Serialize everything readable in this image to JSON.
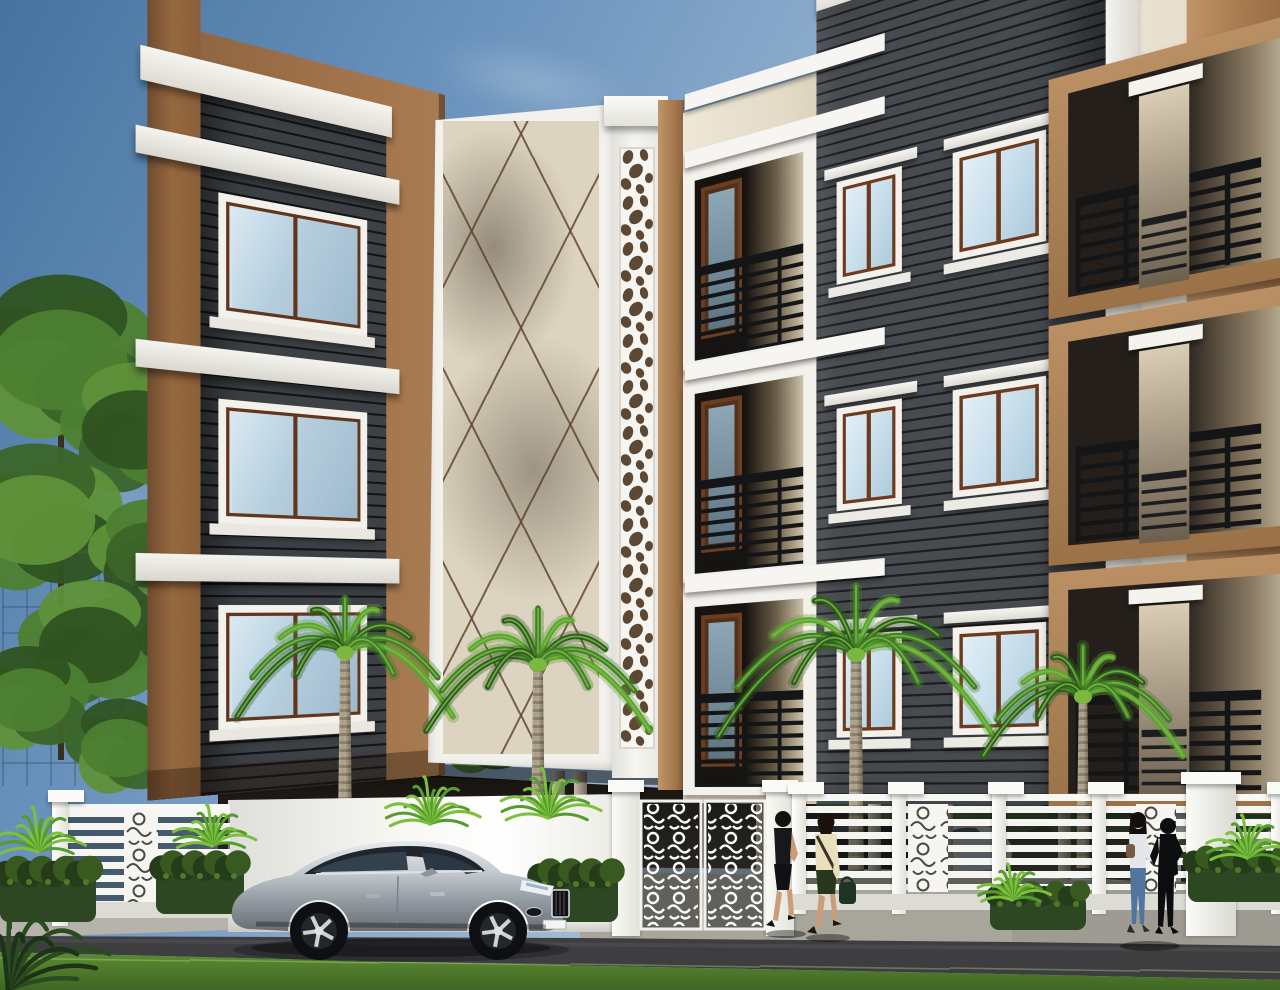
{
  "scene": {
    "type": "3d-architectural-exterior-render",
    "subject": "Three-storey modern apartment building on stilt parking, viewed from the street corner",
    "time_of_day": "day",
    "elements": [
      "blue sky with wispy clouds and flying birds",
      "glass office towers in left background",
      "modern villa with rooftop glass pavilion in right background",
      "apartment block in cream, tan-brown and dark grey horizontal slat cladding with white trims",
      "white perforated jali feature column at the corner",
      "cream corner panel with crossing diagonal groove pattern",
      "balconies with black horizontal railings",
      "wood-framed windows with light blue glazing",
      "open stilt-parking ground floor with columns and two parked cars",
      "white compound wall and white ornamental slat fence with decorative gate",
      "four royal palm trees",
      "bright fern shrubs and dark hedges",
      "silver two-door coupe parked on the road",
      "two women walking toward the gate",
      "two people talking near the right fence",
      "asphalt road, grey paved sidewalk and green grass verge in front"
    ]
  },
  "palette": {
    "sky_top": "#46749f",
    "sky_low": "#d6dee6",
    "cloud": "#ffffff",
    "cream": "#e9e1d0",
    "cream_dark": "#d8cdb8",
    "white_trim": "#f2f1ec",
    "brown": "#a87c52",
    "brown_dark": "#7c5634",
    "brown_light": "#c09468",
    "slat_dark": "#1e2022",
    "slat_light": "#4a4e52",
    "glass": "#c9dfec",
    "wood": "#6e3a1e",
    "railing": "#17181a",
    "fence": "#f5f5f1",
    "wall_white": "#f6f6f1",
    "jali_hole": "#5d4834",
    "asphalt": "#3e3e40",
    "sidewalk": "#aaa79d",
    "grass": "#4f7c2c",
    "grass_light": "#6ea33c",
    "palm_green": "#417d26",
    "palm_green_dark": "#2e5c1d",
    "palm_green_light": "#5fa433",
    "palm_trunk": "#b3a78f",
    "palm_trunk_dark": "#8e8470",
    "tree_green": "#3f6b2d",
    "hedge": "#2c4722",
    "car_silver": "#b9c0c6",
    "car_dark": "#14161a",
    "skin": "#c99d77",
    "glass_tower": "#b7d2da",
    "glass_tower_dark": "#31505a",
    "stone": "#8d8375"
  },
  "building": {
    "floors": 3,
    "front_rows_y": [
      58,
      270,
      482
    ],
    "left_ledge_rows_y": [
      95,
      280,
      465
    ],
    "left_window_rows_y": [
      140,
      325,
      510
    ]
  },
  "objects": {
    "birds": [
      [
        186,
        82
      ],
      [
        212,
        74
      ],
      [
        233,
        90
      ],
      [
        205,
        103
      ],
      [
        258,
        93
      ]
    ],
    "clouds": [
      {
        "x": 730,
        "y": 58,
        "w": 560,
        "h": 150,
        "rot": 9,
        "op": 0.38
      },
      {
        "x": 920,
        "y": 200,
        "w": 470,
        "h": 120,
        "rot": 8,
        "op": 0.3
      },
      {
        "x": 380,
        "y": 36,
        "w": 300,
        "h": 90,
        "rot": 12,
        "op": 0.26
      },
      {
        "x": -60,
        "y": 420,
        "w": 340,
        "h": 170,
        "rot": -5,
        "op": 0.22
      }
    ],
    "trees_left": [
      [
        60,
        360,
        95,
        0
      ],
      [
        135,
        430,
        75,
        1
      ],
      [
        35,
        520,
        85,
        2
      ],
      [
        150,
        555,
        62,
        3
      ],
      [
        90,
        645,
        72,
        1
      ],
      [
        28,
        700,
        60,
        0
      ],
      [
        190,
        645,
        52,
        2
      ],
      [
        235,
        725,
        45,
        3
      ],
      [
        120,
        748,
        55,
        0
      ],
      [
        320,
        760,
        40,
        1
      ],
      [
        480,
        735,
        46,
        2
      ]
    ],
    "trees_right": [
      [
        1230,
        575,
        42,
        1
      ],
      [
        1205,
        615,
        58,
        0
      ],
      [
        1268,
        672,
        66,
        2
      ],
      [
        1182,
        725,
        48,
        1
      ],
      [
        1262,
        788,
        58,
        3
      ],
      [
        1215,
        852,
        38,
        0
      ]
    ],
    "palms": [
      {
        "cx": 345,
        "top": 648,
        "base": 872,
        "tw": 15,
        "s": 108
      },
      {
        "cx": 538,
        "top": 660,
        "base": 882,
        "tw": 15,
        "s": 112
      },
      {
        "cx": 856,
        "top": 650,
        "base": 880,
        "tw": 16,
        "s": 138
      },
      {
        "cx": 1083,
        "top": 692,
        "base": 868,
        "tw": 13,
        "s": 100
      }
    ],
    "ferns": [
      {
        "x": 38,
        "y": 852,
        "s": 52
      },
      {
        "x": 212,
        "y": 846,
        "s": 48
      },
      {
        "x": 430,
        "y": 824,
        "s": 55
      },
      {
        "x": 548,
        "y": 818,
        "s": 58
      },
      {
        "x": 1012,
        "y": 900,
        "s": 42
      },
      {
        "x": 1247,
        "y": 858,
        "s": 50
      }
    ],
    "hedges": [
      [
        0,
        862,
        96,
        60
      ],
      [
        156,
        856,
        88,
        58
      ],
      [
        534,
        864,
        84,
        58
      ],
      [
        990,
        884,
        96,
        46
      ],
      [
        1188,
        850,
        100,
        52
      ]
    ],
    "stilt_columns": [
      352,
      374,
      556,
      668,
      740,
      858,
      932
    ],
    "fence_right_posts": [
      0,
      100,
      200,
      300,
      400,
      479
    ],
    "fence_right_panels": [
      116,
      344
    ],
    "pedestrians": {
      "walking": 2,
      "standing": 2
    },
    "vehicles": {
      "foreground_car": "silver two-door coupe facing right",
      "parked_under_stilt": 2
    }
  }
}
